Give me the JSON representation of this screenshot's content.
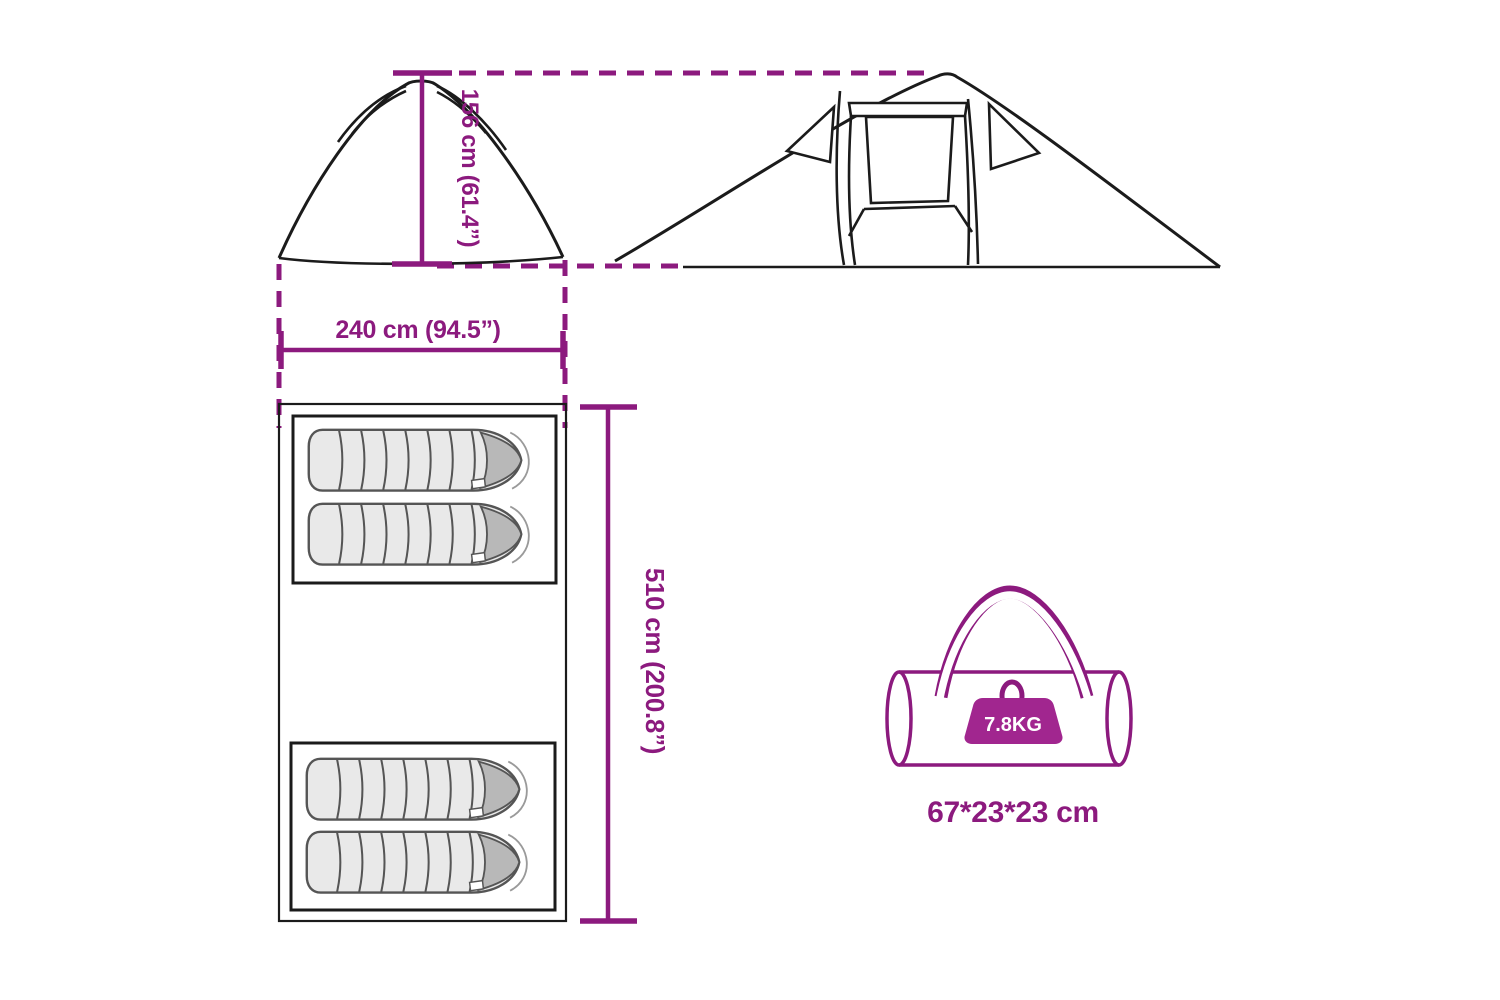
{
  "diagram": {
    "accent_color": "#8C1A7E",
    "weight_badge_color": "#A1268F",
    "sleeping_bag_count": 4,
    "labels": {
      "height": "156 cm (61.4”)",
      "width": "240 cm (94.5”)",
      "length": "510 cm (200.8”)",
      "bag_weight": "7.8KG",
      "bag_size": "67*23*23 cm"
    }
  }
}
